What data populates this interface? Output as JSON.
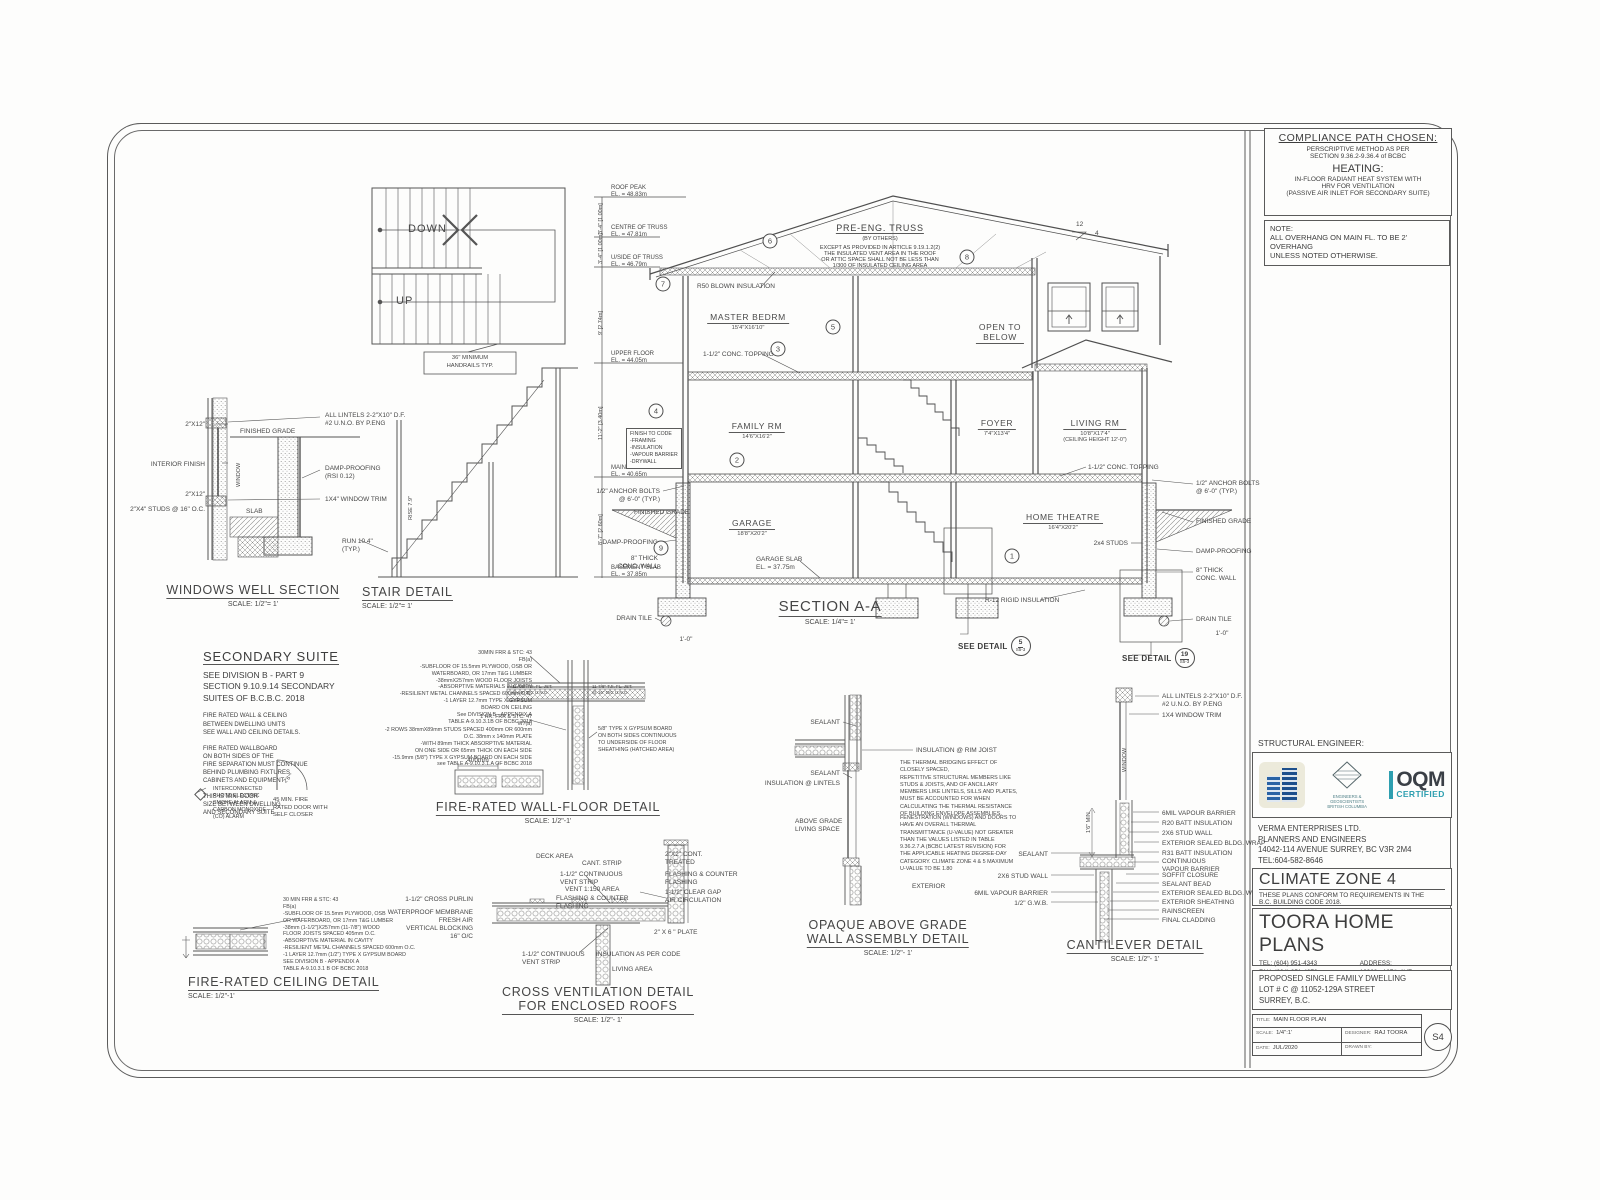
{
  "compliance": {
    "title": "COMPLIANCE PATH CHOSEN:",
    "line1": "PERSCRIPTIVE METHOD AS PER",
    "line2": "SECTION 9.36.2-9.36.4 of BCBC",
    "heating_title": "HEATING:",
    "heating1": "IN-FLOOR RADIANT HEAT SYSTEM WITH",
    "heating2": "HRV FOR VENTILATION",
    "heating3": "(PASSIVE AIR INLET FOR SECONDARY SUITE)"
  },
  "note": {
    "label": "NOTE:",
    "text": "ALL OVERHANG ON MAIN FL. TO BE 2' OVERHANG\nUNLESS  NOTED OTHERWISE."
  },
  "stair_plan": {
    "down": "DOWN",
    "up": "UP",
    "note": "36\" MINIMUM\nHANDRAILS TYP."
  },
  "windows_well": {
    "title": "WINDOWS WELL SECTION",
    "scale": "SCALE: 1/2\"= 1'",
    "labels": [
      {
        "t": "2\"X12\"",
        "x": 205,
        "y": 421,
        "c": "r"
      },
      {
        "t": "INTERIOR FINISH",
        "x": 205,
        "y": 461,
        "c": "r"
      },
      {
        "t": "2\"X12\"",
        "x": 205,
        "y": 491,
        "c": "r"
      },
      {
        "t": "2\"X4\" STUDS @ 16\" O.C.",
        "x": 205,
        "y": 506,
        "c": "r"
      },
      {
        "t": "FINISHED GRADE",
        "x": 240,
        "y": 428
      },
      {
        "t": "WINDOW",
        "x": 236,
        "y": 487,
        "c": "v s6"
      },
      {
        "t": "SLAB",
        "x": 246,
        "y": 508
      },
      {
        "t": "ALL LINTELS 2-2\"X10\" D.F.\n#2 U.N.O. BY P.ENG",
        "x": 325,
        "y": 412
      },
      {
        "t": "DAMP-PROOFING\n(RSI 0.12)",
        "x": 325,
        "y": 465
      },
      {
        "t": "1X4\" WINDOW TRIM",
        "x": 325,
        "y": 496
      }
    ]
  },
  "stair_detail": {
    "title": "STAIR DETAIL",
    "scale": "SCALE: 1/2\"= 1'",
    "labels": [
      {
        "t": "RUN 10.4\"\n(TYP.)",
        "x": 342,
        "y": 538
      },
      {
        "t": "RISE 7.9\"",
        "x": 408,
        "y": 520,
        "c": "v s6"
      }
    ]
  },
  "section": {
    "title": "SECTION A-A",
    "scale": "SCALE: 1/4\"= 1'",
    "truss_title": "PRE-ENG. TRUSS",
    "truss_sub": "(BY OTHERS)",
    "truss_note": "EXCEPT AS PROVIDED IN ARTICLE 9.19.1.2(2)\nTHE INSULATED VENT AREA IN THE ROOF\nOR ATTIC SPACE SHALL NOT BE LESS THAN\n1/300 OF INSULATED CEILING AREA",
    "finish_box": "FINISH TO CODE\n-FRAMING\n-INSULATION\n-VAPOUR BARRIER\n-DRYWALL",
    "rooms": [
      {
        "name": "MASTER BEDRM",
        "dim": "15'4\"X16'10\""
      },
      {
        "name": "OPEN TO\nBELOW",
        "dim": ""
      },
      {
        "name": "FAMILY RM",
        "dim": "14'6\"X16'2\""
      },
      {
        "name": "FOYER",
        "dim": "7'4\"X13'4\""
      },
      {
        "name": "LIVING RM",
        "dim": "10'8\"X17'4\"",
        "note": "(CEILING HEIGHT 12'-0\")"
      },
      {
        "name": "GARAGE",
        "dim": "18'8\"X20'2\""
      },
      {
        "name": "HOME THEATRE",
        "dim": "16'4\"X20'2\""
      }
    ],
    "elevations": [
      {
        "t": "ROOF PEAK\nEL. = 48.83m",
        "x": 611,
        "y": 185,
        "c": "el"
      },
      {
        "t": "CENTRE OF TRUSS\nEL. = 47.81m",
        "x": 611,
        "y": 225,
        "c": "el"
      },
      {
        "t": "U/SIDE OF TRUSS\nEL. = 46.79m",
        "x": 611,
        "y": 255,
        "c": "el"
      },
      {
        "t": "UPPER FLOOR\nEL. = 44.05m",
        "x": 611,
        "y": 351,
        "c": "el"
      },
      {
        "t": "MAIN FLOOR\nEL. = 40.65m",
        "x": 611,
        "y": 465,
        "c": "el"
      },
      {
        "t": "BASEMENT SLAB\nEL. = 37.85m",
        "x": 611,
        "y": 565,
        "c": "el"
      }
    ],
    "dims": [
      {
        "t": "3'-4\"  [1.00m]",
        "x": 598,
        "y": 234,
        "c": "v s6"
      },
      {
        "t": "3'-4\"  [1.00m]",
        "x": 598,
        "y": 264,
        "c": "v s6"
      },
      {
        "t": "9'  [2.74m]",
        "x": 598,
        "y": 335,
        "c": "v s6"
      },
      {
        "t": "11'-2\"  [3.40m]",
        "x": 598,
        "y": 440,
        "c": "v s6"
      },
      {
        "t": "8'-7\"  [2.60m]",
        "x": 598,
        "y": 545,
        "c": "v s6"
      }
    ],
    "labels": [
      {
        "t": "R50 BLOWN INSULATION",
        "x": 697,
        "y": 283
      },
      {
        "t": "1-1/2\" CONC. TOPPING",
        "x": 703,
        "y": 351
      },
      {
        "t": "1-1/2\" CONC. TOPPING",
        "x": 1088,
        "y": 464
      },
      {
        "t": "1/2\" ANCHOR BOLTS\n@ 6'-0\" (TYP.)",
        "x": 660,
        "y": 488,
        "c": "r"
      },
      {
        "t": "1/2\" ANCHOR BOLTS\n@ 6'-0\" (TYP.)",
        "x": 1196,
        "y": 480
      },
      {
        "t": "FINISHED GRADE",
        "x": 634,
        "y": 509
      },
      {
        "t": "FINISHED GRADE",
        "x": 1196,
        "y": 518
      },
      {
        "t": "DAMP-PROOFING",
        "x": 658,
        "y": 539,
        "c": "r"
      },
      {
        "t": "DAMP-PROOFING",
        "x": 1196,
        "y": 548
      },
      {
        "t": "8\" THICK\nCONC. WALL",
        "x": 658,
        "y": 555,
        "c": "r"
      },
      {
        "t": "8\" THICK\nCONC. WALL",
        "x": 1196,
        "y": 567
      },
      {
        "t": "DRAIN TILE",
        "x": 652,
        "y": 615,
        "c": "r"
      },
      {
        "t": "DRAIN TILE",
        "x": 1196,
        "y": 616
      },
      {
        "t": "GARAGE SLAB\nEL. = 37.75m",
        "x": 756,
        "y": 556
      },
      {
        "t": "2x4 STUDS",
        "x": 1128,
        "y": 540,
        "c": "r"
      },
      {
        "t": "R-12 RIGID INSULATION",
        "x": 985,
        "y": 597
      },
      {
        "t": "1'-0\"",
        "x": 686,
        "y": 636,
        "c": "c"
      },
      {
        "t": "1'-0\"",
        "x": 1222,
        "y": 630,
        "c": "c"
      },
      {
        "t": "12",
        "x": 1076,
        "y": 221
      },
      {
        "t": "4",
        "x": 1095,
        "y": 230
      }
    ],
    "bubbles": [
      {
        "n": "6",
        "x": 770,
        "y": 241
      },
      {
        "n": "8",
        "x": 967,
        "y": 257
      },
      {
        "n": "7",
        "x": 663,
        "y": 284
      },
      {
        "n": "5",
        "x": 833,
        "y": 327
      },
      {
        "n": "3",
        "x": 778,
        "y": 349
      },
      {
        "n": "4",
        "x": 656,
        "y": 411
      },
      {
        "n": "2",
        "x": 737,
        "y": 460
      },
      {
        "n": "9",
        "x": 661,
        "y": 548
      },
      {
        "n": "1",
        "x": 1012,
        "y": 556
      }
    ],
    "see_details": [
      {
        "label": "SEE DETAIL",
        "num": "5",
        "ref": "S5-3"
      },
      {
        "label": "SEE DETAIL",
        "num": "19",
        "ref": "S5-3"
      }
    ]
  },
  "secondary_suite": {
    "title": "SECONDARY SUITE",
    "sub": "SEE DIVISION B - PART 9\nSECTION 9.10.9.14 SECONDARY\nSUITES OF B.C.B.C. 2018",
    "p1": "FIRE RATED WALL & CEILING\nBETWEEN DWELLING UNITS\nSEE WALL AND CEILING DETAILS.",
    "p2": "FIRE RATED WALLBOARD\nON BOTH SIDES OF THE\nFIRE SEPARATION MUST CONTINUE\nBEHIND PLUMBING FIXTURES,\nCABINETS AND EQUIPMENT",
    "p3": "THIS IS MIN. DOOR\nSIZE BETWEEN DWELLING\nAND SECONDARY SUITE",
    "alarm": "INTERCONNECTED\nPHOTO ELECTRIC\nSMOKE ALARM &\nCARBON MONOXIDE\n(CO) ALARM",
    "door_size": "2'6\"",
    "door_note": "45 MIN. FIRE\nRATED DOOR WITH\nSELF CLOSER"
  },
  "fire_wall_floor": {
    "title": "FIRE-RATED WALL-FLOOR DETAIL",
    "scale": "SCALE: 1/2\"-1'",
    "block1": "30MIN FRR & STC: 43\nFB(a)\n-SUBFLOOR OF 15.5mm PLYWOOD, OSB OR\nWATERBOARD, OR 17mm T&G LUMBER\n-38mmX257mm WOOD FLOOR JOISTS\n-ABSORPTIVE MATERIALS IN CAVITY\n-RESILIENT METAL CHANNELS SPACED 600mm O.C.\n-1 LAYER 12.7mm TYPE X GYPSUM\nBOARD ON CEILING\nSee DIVISION B - APPENDIX A\nTABLE A-9.10.3.1B OF BCBC 2018",
    "mid": "1 HR. FRR & STC: 47\nW7(a)",
    "block2": "-2 ROWS 38mmX89mm STUDS SPACED 400mm OR 600mm\nO.C. 38mm x 140mm PLATE\n-WITH 89mm THICK ABSORPTIVE MATERIAL\nON ONE SIDE OR 65mm THICK ON EACH SIDE\n-15.9mm (5/8\") TYPE X GYPSUM BOARD ON EACH SIDE\nsee TABLE A-9.10.3.1.A OF BCBC 2018",
    "joist1": "11-7/8\" TJI. FL. JST.\n@ 16\" O/C U.N.O.",
    "joist2": "11-7/8\" TJI. FL. JST.\n@ 16\" O/C U.N.O.",
    "gypsum": "5/8\" TYPE X GYPSUM BOARD\nON BOTH SIDES CONTINUOUS\nTO UNDERSIDE OF FLOOR\nSHEATHING (HATCHED AREA)",
    "dim400": "400mm"
  },
  "fire_ceiling": {
    "title": "FIRE-RATED CEILING DETAIL",
    "scale": "SCALE: 1/2\"-1'",
    "block": "30 MIN FRR & STC: 43\nFB(a)\n-SUBFLOOR OF 15.5mm PLYWOOD, OSB\nOR WAFERBOARD, OR 17mm T&G LUMBER\n-38mm (1-1/2\")X257mm (11-7/8\") WOOD\nFLOOR JOISTS SPACED 405mm O.C.\n-ABSORPTIVE MATERIAL IN CAVITY\n-RESILIENT METAL CHANNELS SPACED 600mm O.C.\n-1 LAYER 12.7mm (1/2\") TYPE X GYPSUM BOARD\nSEE DIVISION B - APPENDIX A\nTABLE A-9.10.3.1 B OF BCBC 2018"
  },
  "cross_vent": {
    "title": "CROSS VENTILATION DETAIL\nFOR ENCLOSED ROOFS",
    "scale": "SCALE:  1/2\"- 1'",
    "labels": [
      {
        "t": "DECK AREA",
        "x": 536,
        "y": 853
      },
      {
        "t": "CANT. STRIP",
        "x": 582,
        "y": 860
      },
      {
        "t": "1-1/2\" CONTINUOUS\nVENT STRIP",
        "x": 560,
        "y": 871
      },
      {
        "t": "VENT 1:150 AREA",
        "x": 565,
        "y": 886
      },
      {
        "t": "FLASHING & COUNTER\nFLASHING",
        "x": 556,
        "y": 895
      },
      {
        "t": "2\"X2\" CONT.\nTREATED",
        "x": 665,
        "y": 851
      },
      {
        "t": "FLASHING & COUNTER\nFLASHING",
        "x": 665,
        "y": 871
      },
      {
        "t": "1-1/2\" CLEAR GAP\nAIR CIRCULATION",
        "x": 665,
        "y": 889
      },
      {
        "t": "2\" X 6 \" PLATE",
        "x": 654,
        "y": 929
      },
      {
        "t": "INSULATION AS PER CODE",
        "x": 596,
        "y": 951
      },
      {
        "t": "LIVING AREA",
        "x": 612,
        "y": 966
      },
      {
        "t": "1-1/2\" CONTINUOUS\nVENT STRIP",
        "x": 522,
        "y": 951
      },
      {
        "t": "1-1/2\" CROSS PURLIN",
        "x": 473,
        "y": 896,
        "c": "r"
      },
      {
        "t": "WATERPROOF MEMBRANE\nFRESH AIR",
        "x": 473,
        "y": 909,
        "c": "r"
      },
      {
        "t": "VERTICAL BLOCKING\n16\" O/C",
        "x": 473,
        "y": 925,
        "c": "r"
      }
    ]
  },
  "opaque_wall": {
    "title": "OPAQUE ABOVE GRADE\nWALL ASSEMBLY DETAIL",
    "scale": "SCALE:  1/2\"- 1'",
    "para1": "THE THERMAL BRIDGING EFFECT OF\nCLOSELY SPACED,\nREPETITIVE STRUCTURAL MEMBERS LIKE\nSTUDS & JOISTS, AND OF ANCILLARY\nMEMBERS LIKE LINTELS, SILLS AND PLATES,\nMUST BE ACCOUNTED FOR WHEN\nCALCULATING THE THERMAL RESISTANCE\nOF BUILDING ENVELOPE ASSEMBLIES.",
    "para2": "FENESTRATION (WINDOWS) AND DOORS TO\nHAVE AN OVERALL THERMAL\nTRANSMITTANCE (U-VALUE) NOT GREATER\nTHAN THE VALUES LISTED IN TABLE\n9.36.2.7.A (BCBC LATEST REVISION) FOR\nTHE APPLICABLE HEATING DEGREE-DAY\nCATEGORY. CLIMATE ZONE 4 & 5 MAXIMUM\nU-VALUE TO BE 1.80",
    "labels": [
      {
        "t": "SEALANT",
        "x": 840,
        "y": 719,
        "c": "r"
      },
      {
        "t": "INSULATION @ RIM JOIST",
        "x": 916,
        "y": 747
      },
      {
        "t": "SEALANT",
        "x": 840,
        "y": 770,
        "c": "r"
      },
      {
        "t": "INSULATION @ LINTELS",
        "x": 840,
        "y": 780,
        "c": "r"
      },
      {
        "t": "ABOVE GRADE\nLIVING SPACE",
        "x": 795,
        "y": 818
      },
      {
        "t": "EXTERIOR",
        "x": 912,
        "y": 883
      }
    ]
  },
  "cantilever": {
    "title": "CANTILEVER DETAIL",
    "scale": "SCALE:  1/2\"- 1'",
    "labels": [
      {
        "t": "ALL LINTELS 2-2\"X10\" D.F.\n#2 U.N.O. BY P.ENG",
        "x": 1162,
        "y": 693
      },
      {
        "t": "1X4 WINDOW TRIM",
        "x": 1162,
        "y": 712
      },
      {
        "t": "WINDOW",
        "x": 1122,
        "y": 772,
        "c": "v s6"
      },
      {
        "t": "1'6\" MIN",
        "x": 1086,
        "y": 833,
        "c": "v s6"
      },
      {
        "t": "6MIL VAPOUR BARRIER",
        "x": 1162,
        "y": 810
      },
      {
        "t": "R20 BATT INSULATION",
        "x": 1162,
        "y": 820
      },
      {
        "t": "2X6 STUD WALL",
        "x": 1162,
        "y": 830
      },
      {
        "t": "EXTERIOR SEALED BLDG. WRAP",
        "x": 1162,
        "y": 840
      },
      {
        "t": "R31 BATT INSULATION",
        "x": 1162,
        "y": 850
      },
      {
        "t": "CONTINUOUS\nVAPOUR BARRIER",
        "x": 1162,
        "y": 858
      },
      {
        "t": "SOFFIT CLOSURE",
        "x": 1162,
        "y": 872
      },
      {
        "t": "SEALANT BEAD",
        "x": 1162,
        "y": 881
      },
      {
        "t": "EXTERIOR SEALED BLDG. WRAP",
        "x": 1162,
        "y": 890
      },
      {
        "t": "EXTERIOR SHEATHING",
        "x": 1162,
        "y": 899
      },
      {
        "t": "RAINSCREEN",
        "x": 1162,
        "y": 908
      },
      {
        "t": "FINAL CLADDING",
        "x": 1162,
        "y": 917
      },
      {
        "t": "SEALANT",
        "x": 1048,
        "y": 851,
        "c": "r"
      },
      {
        "t": "2X6 STUD WALL",
        "x": 1048,
        "y": 873,
        "c": "r"
      },
      {
        "t": "6MIL VAPOUR BARRIER",
        "x": 1048,
        "y": 890,
        "c": "r"
      },
      {
        "t": "1/2\" G.W.B.",
        "x": 1048,
        "y": 900,
        "c": "r"
      }
    ]
  },
  "engineer": {
    "label": "STRUCTURAL ENGINEER:",
    "diamond_caption": "ENGINEERS &\nGEOSCIENTISTS\nBRITISH COLUMBIA",
    "oqm_line1": "OQM",
    "oqm_line2": "CERTIFIED",
    "firm": "VERMA ENTERPRISES LTD.\nPLANNERS AND ENGINEERS\n14042-114 AVENUE SURREY, BC V3R 2M4\nTEL:604-582-8646"
  },
  "climate": {
    "title": "CLIMATE ZONE 4",
    "text": "THESE PLANS CONFORM TO REQUIREMENTS IN THE\nB.C. BUILDING CODE 2018."
  },
  "company": {
    "name": "TOORA HOME PLANS",
    "tel": "TEL: (604) 951-4343",
    "fax": "FAX: (604) 951-4373",
    "email": "EMAIL: toorahomes@gmail.com",
    "address_label": "ADDRESS:",
    "address1": "12968 - 107th AVE",
    "address2": "SURREY, B.C. V3T 2E9"
  },
  "project": {
    "text": "PROPOSED SINGLE FAMILY DWELLING\nLOT # C @ 11052-129A STREET\nSURREY, B.C."
  },
  "titleblock": {
    "title_label": "TITLE:",
    "title_value": "MAIN FLOOR PLAN",
    "scale_label": "SCALE:",
    "scale_value": "1/4\":1'",
    "designer_label": "DESIGNER:",
    "designer_value": "RAJ TOORA",
    "date_label": "DATE:",
    "date_value": "JUL/2020",
    "drawnby_label": "DRAWN BY:",
    "drawnby_value": "",
    "sheet_no": "S4"
  }
}
